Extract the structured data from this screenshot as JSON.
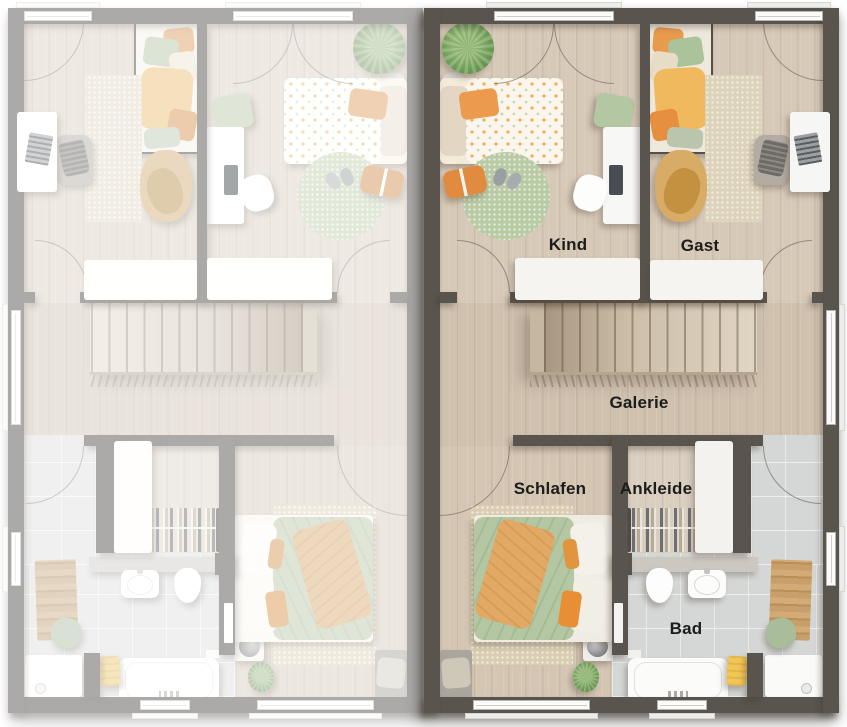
{
  "floorplan": {
    "description": "Duplex upper floor plan; right unit highlighted with room labels, left unit shown mirrored and faded",
    "units": [
      {
        "id": "left",
        "mirrored": true,
        "faded": true,
        "labels_visible": false
      },
      {
        "id": "right",
        "mirrored": false,
        "faded": false,
        "labels_visible": true
      }
    ],
    "rooms": [
      {
        "id": "kind",
        "label": "Kind"
      },
      {
        "id": "gast",
        "label": "Gast"
      },
      {
        "id": "galerie",
        "label": "Galerie"
      },
      {
        "id": "schlafen",
        "label": "Schlafen"
      },
      {
        "id": "ankleide",
        "label": "Ankleide"
      },
      {
        "id": "bad",
        "label": "Bad"
      }
    ],
    "colors": {
      "wall": "#59544e",
      "floor_bedroom": "#d7c9b8",
      "floor_galerie": "#cfc1ae",
      "floor_schlafen": "#d4c6b3",
      "floor_ankleide": "#d9cec0",
      "floor_tile": "#d5d7d6",
      "accent_orange": "#e89a4d",
      "accent_green": "#b3c7a2",
      "accent_yellow": "#f0b95e",
      "label_text": "#1c1c1c"
    }
  }
}
